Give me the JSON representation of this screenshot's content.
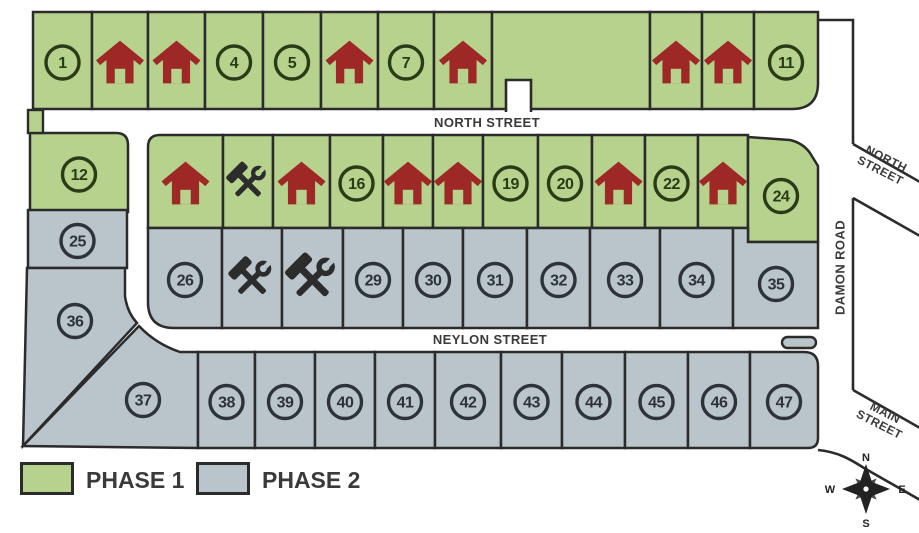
{
  "streets": {
    "north": "NORTH STREET",
    "neylon": "NEYLON STREET",
    "damon": "DAMON ROAD",
    "north_diag": "NORTH STREET",
    "main_diag": "MAIN STREET"
  },
  "legend": {
    "items": [
      {
        "label": "PHASE 1",
        "color": "#b6d28c"
      },
      {
        "label": "PHASE 2",
        "color": "#bac4cb"
      }
    ]
  },
  "compass": {
    "n": "N",
    "e": "E",
    "s": "S",
    "w": "W"
  },
  "palette": {
    "phase1_fill": "#b6d28c",
    "phase1_ink": "#2b3a17",
    "phase2_fill": "#bac4cb",
    "phase2_ink": "#2d3339",
    "house": "#9e2826",
    "tools": "#2c2c2c",
    "line": "#2b2b2b",
    "road": "#ffffff",
    "label": "#3a3a3a"
  },
  "lots": [
    {
      "number": "1",
      "phase": 1,
      "marker": "number",
      "x": 33,
      "y": 12,
      "w": 59,
      "h": 97
    },
    {
      "number": null,
      "phase": 1,
      "marker": "house",
      "x": 92,
      "y": 12,
      "w": 56,
      "h": 97
    },
    {
      "number": null,
      "phase": 1,
      "marker": "house",
      "x": 148,
      "y": 12,
      "w": 57,
      "h": 97
    },
    {
      "number": "4",
      "phase": 1,
      "marker": "number",
      "x": 205,
      "y": 12,
      "w": 58,
      "h": 97
    },
    {
      "number": "5",
      "phase": 1,
      "marker": "number",
      "x": 263,
      "y": 12,
      "w": 58,
      "h": 97
    },
    {
      "number": null,
      "phase": 1,
      "marker": "house",
      "x": 321,
      "y": 12,
      "w": 57,
      "h": 97
    },
    {
      "number": "7",
      "phase": 1,
      "marker": "number",
      "x": 378,
      "y": 12,
      "w": 56,
      "h": 97
    },
    {
      "number": null,
      "phase": 1,
      "marker": "house",
      "x": 434,
      "y": 12,
      "w": 58,
      "h": 97
    },
    {
      "number": null,
      "phase": 1,
      "marker": "open",
      "x": 492,
      "y": 12,
      "w": 158,
      "h": 97
    },
    {
      "number": null,
      "phase": 1,
      "marker": "house",
      "x": 650,
      "y": 12,
      "w": 52,
      "h": 97
    },
    {
      "number": null,
      "phase": 1,
      "marker": "house",
      "x": 702,
      "y": 12,
      "w": 52,
      "h": 97
    },
    {
      "number": "11",
      "phase": 1,
      "marker": "number",
      "x": 754,
      "y": 12,
      "w": 64,
      "h": 97,
      "r": [
        0,
        0,
        26,
        0
      ]
    },
    {
      "number": "12",
      "phase": 1,
      "marker": "number",
      "x": 30,
      "y": 133,
      "w": 98,
      "h": 79,
      "r": [
        0,
        12,
        0,
        0
      ]
    },
    {
      "number": null,
      "phase": 1,
      "marker": "house",
      "x": 148,
      "y": 135,
      "w": 75,
      "h": 93,
      "r": [
        12,
        0,
        0,
        0
      ]
    },
    {
      "number": null,
      "phase": 1,
      "marker": "construction",
      "x": 223,
      "y": 135,
      "w": 50,
      "h": 93,
      "size": 0.92
    },
    {
      "number": null,
      "phase": 1,
      "marker": "house",
      "x": 273,
      "y": 135,
      "w": 57,
      "h": 93
    },
    {
      "number": "16",
      "phase": 1,
      "marker": "number",
      "x": 330,
      "y": 135,
      "w": 53,
      "h": 93
    },
    {
      "number": null,
      "phase": 1,
      "marker": "house",
      "x": 383,
      "y": 135,
      "w": 50,
      "h": 93
    },
    {
      "number": null,
      "phase": 1,
      "marker": "house",
      "x": 433,
      "y": 135,
      "w": 50,
      "h": 93
    },
    {
      "number": "19",
      "phase": 1,
      "marker": "number",
      "x": 483,
      "y": 135,
      "w": 55,
      "h": 93
    },
    {
      "number": "20",
      "phase": 1,
      "marker": "number",
      "x": 538,
      "y": 135,
      "w": 54,
      "h": 93
    },
    {
      "number": null,
      "phase": 1,
      "marker": "house",
      "x": 592,
      "y": 135,
      "w": 53,
      "h": 93
    },
    {
      "number": "22",
      "phase": 1,
      "marker": "number",
      "x": 645,
      "y": 135,
      "w": 53,
      "h": 93
    },
    {
      "number": null,
      "phase": 1,
      "marker": "house",
      "x": 698,
      "y": 135,
      "w": 50,
      "h": 93
    },
    {
      "number": "24",
      "phase": 1,
      "marker": "number",
      "path": "M748,137 L790,140 Q803,143 810,153 L818,166 L818,242 L748,242 Z",
      "mx": 781,
      "my": 196
    },
    {
      "number": "25",
      "phase": 2,
      "marker": "number",
      "x": 28,
      "y": 210,
      "w": 99,
      "h": 58
    },
    {
      "number": "26",
      "phase": 2,
      "marker": "number",
      "x": 148,
      "y": 228,
      "w": 74,
      "h": 100,
      "r": [
        0,
        0,
        0,
        26
      ]
    },
    {
      "number": null,
      "phase": 2,
      "marker": "construction",
      "x": 222,
      "y": 228,
      "w": 60,
      "h": 100
    },
    {
      "number": null,
      "phase": 2,
      "marker": "construction",
      "x": 282,
      "y": 228,
      "w": 61,
      "h": 100,
      "size": 1.16
    },
    {
      "number": "29",
      "phase": 2,
      "marker": "number",
      "x": 343,
      "y": 228,
      "w": 60,
      "h": 100
    },
    {
      "number": "30",
      "phase": 2,
      "marker": "number",
      "x": 403,
      "y": 228,
      "w": 60,
      "h": 100
    },
    {
      "number": "31",
      "phase": 2,
      "marker": "number",
      "x": 463,
      "y": 228,
      "w": 64,
      "h": 100
    },
    {
      "number": "32",
      "phase": 2,
      "marker": "number",
      "x": 527,
      "y": 228,
      "w": 63,
      "h": 100
    },
    {
      "number": "33",
      "phase": 2,
      "marker": "number",
      "x": 590,
      "y": 228,
      "w": 70,
      "h": 100
    },
    {
      "number": "34",
      "phase": 2,
      "marker": "number",
      "x": 660,
      "y": 228,
      "w": 73,
      "h": 100
    },
    {
      "number": "35",
      "phase": 2,
      "marker": "number",
      "path": "M733,228 L748,228 L748,242 L818,242 L818,328 L733,328 Z",
      "mx": 776,
      "my": 284
    },
    {
      "number": "36",
      "phase": 2,
      "marker": "number",
      "path": "M27,268 L125,268 L125,296 Q127,312 137,323 L23,446 Z",
      "mx": 75,
      "my": 321
    },
    {
      "number": "37",
      "phase": 2,
      "marker": "number",
      "path": "M23,446 L139,326 Q156,344 180,352 L198,352 L198,448 Z",
      "mx": 143,
      "my": 400
    },
    {
      "number": "38",
      "phase": 2,
      "marker": "number",
      "x": 198,
      "y": 352,
      "w": 57,
      "h": 96
    },
    {
      "number": "39",
      "phase": 2,
      "marker": "number",
      "x": 255,
      "y": 352,
      "w": 60,
      "h": 96
    },
    {
      "number": "40",
      "phase": 2,
      "marker": "number",
      "x": 315,
      "y": 352,
      "w": 60,
      "h": 96
    },
    {
      "number": "41",
      "phase": 2,
      "marker": "number",
      "x": 375,
      "y": 352,
      "w": 60,
      "h": 96
    },
    {
      "number": "42",
      "phase": 2,
      "marker": "number",
      "x": 435,
      "y": 352,
      "w": 66,
      "h": 96
    },
    {
      "number": "43",
      "phase": 2,
      "marker": "number",
      "x": 501,
      "y": 352,
      "w": 61,
      "h": 96
    },
    {
      "number": "44",
      "phase": 2,
      "marker": "number",
      "x": 562,
      "y": 352,
      "w": 63,
      "h": 96
    },
    {
      "number": "45",
      "phase": 2,
      "marker": "number",
      "x": 625,
      "y": 352,
      "w": 63,
      "h": 96
    },
    {
      "number": "46",
      "phase": 2,
      "marker": "number",
      "x": 688,
      "y": 352,
      "w": 62,
      "h": 96
    },
    {
      "number": "47",
      "phase": 2,
      "marker": "number",
      "x": 750,
      "y": 352,
      "w": 68,
      "h": 96,
      "r": [
        0,
        14,
        10,
        0
      ]
    }
  ]
}
